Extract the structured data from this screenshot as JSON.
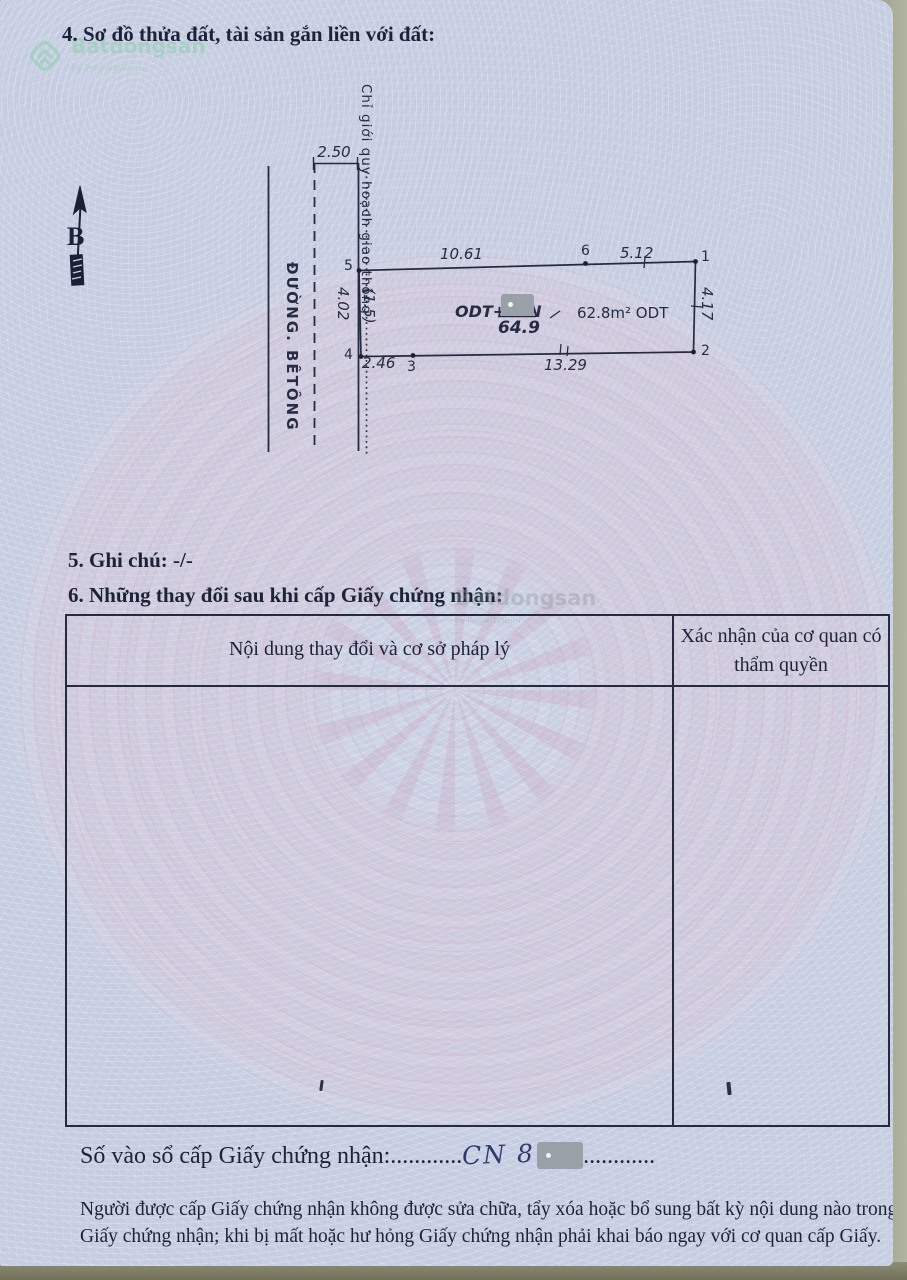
{
  "brand": {
    "name": "Batdongsan",
    "sub": "by PropertyGuru"
  },
  "sections": {
    "s4_title": "4. Sơ đồ thửa đất, tài sản gắn liền với đất:",
    "s5_title": "5. Ghi chú: -/-",
    "s6_title": "6. Những thay đổi sau khi cấp Giấy chứng nhận:"
  },
  "diagram": {
    "north_label": "B",
    "road_name": "ĐƯỜNG. BÊTÔNG",
    "planning_boundary_label": "Chỉ giới quy hoạch giao thông",
    "dims": {
      "road_width": "2.50",
      "top": "10.61",
      "top_right": "5.12",
      "right": "4.17",
      "left": "4.02",
      "setback": "(1.5)",
      "bottom_left": "2.46",
      "bottom": "13.29"
    },
    "labels": {
      "land_use": "ODT+CLN",
      "area_fraction": "64.9",
      "area_right": "62.8m² ODT"
    },
    "vertices": {
      "v1": "1",
      "v2": "2",
      "v3": "3",
      "v4": "4",
      "v5": "5",
      "v6": "6"
    }
  },
  "table": {
    "header_left": "Nội dung thay đổi và cơ sở pháp lý",
    "header_right": "Xác nhận của cơ quan có thẩm quyền"
  },
  "registry": {
    "label": "Số vào sổ cấp Giấy chứng nhận:",
    "dots_before": "............",
    "value": "CN 8",
    "dots_after": "............"
  },
  "footer": {
    "note": "Người được cấp Giấy chứng nhận không được sửa chữa, tẩy xóa hoặc bổ sung bất kỳ nội dung nào trong Giấy chứng nhận; khi bị mất hoặc hư hỏng Giấy chứng nhận phải khai báo ngay với cơ quan cấp Giấy."
  },
  "colors": {
    "paper": "#ccd3e5",
    "ink": "#1c2338",
    "brand_green": "#93cfb0",
    "redaction_grey": "#9aa0a8",
    "desk_olive": "#6f7057"
  }
}
